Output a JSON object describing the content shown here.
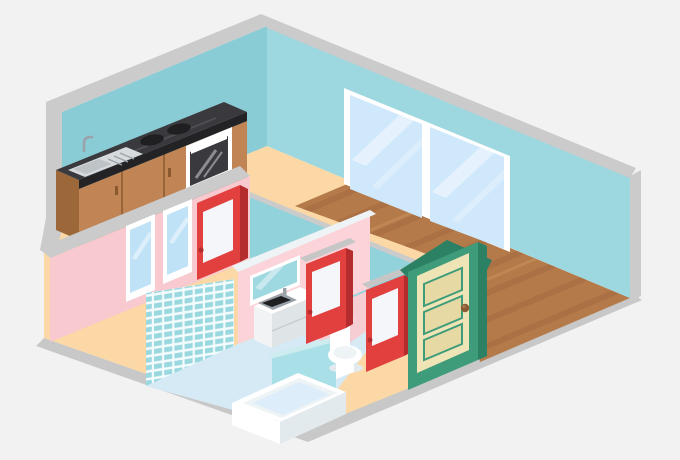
{
  "scene": {
    "type": "isometric-apartment-cutaway-illustration",
    "rooms": [
      {
        "name": "kitchen",
        "floor": "peach",
        "objects": [
          "kitchen-counter",
          "kitchen-sink",
          "stove-burners",
          "oven"
        ]
      },
      {
        "name": "living-room",
        "floor": "wood-planks",
        "objects": [
          "double-window",
          "entry-door"
        ]
      },
      {
        "name": "bedroom",
        "floor": "peach",
        "objects": [
          "bedroom-window-1",
          "bedroom-window-2",
          "bedroom-door"
        ]
      },
      {
        "name": "bathroom",
        "floor": "light-blue",
        "objects": [
          "tiled-wall",
          "bathtub",
          "vanity-sink",
          "mirror",
          "toilet",
          "half-wall",
          "bathroom-door",
          "wc-door"
        ]
      }
    ],
    "doors": {
      "red_interior_doors": 3,
      "green_entry_door": 1
    },
    "windows": {
      "large_double_window": 1,
      "bedroom_windows": 2
    }
  },
  "colors": {
    "bg": "#f2f2f2",
    "slab": "#c8c8c8",
    "cap": "#cbcbcb",
    "lintel": "#c6c6c6",
    "wallBlueLeft": "#8accd6",
    "wallBlueRight": "#9dd7df",
    "partitionTeal": "#92d2db",
    "floorPeach": "#fbd8a6",
    "wood": "#b47a49",
    "woodDark": "#a26940",
    "woodLight": "#c28b58",
    "pinkWall": "#f8c9cf",
    "pinkLight": "#fbd3d8",
    "bathFloor": "#d6eaf6",
    "bathPinkFloor": "#f5cdd3",
    "tileBg": "#f3fbfc",
    "tileTeal": "#9ad8e0",
    "halfWall": "#a9dfe6",
    "halfWallTop": "#cdecf0",
    "white": "#ffffff",
    "offWhite": "#eef3f6",
    "paleShadow": "#e2eaee",
    "glass": "#cfe8fb",
    "glassSmall": "#bfe2f7",
    "streak": "#ffffff",
    "mirror": "#9ed8e0",
    "red": "#e2403e",
    "redDark": "#b52c2e",
    "panelWhite": "#f4f6fa",
    "green": "#3f9c7b",
    "greenDark": "#2c8063",
    "cream": "#efe4b5",
    "creamDark": "#e7d9a4",
    "knob": "#8a5a33",
    "knobLight": "#a97a4a",
    "cabinet": "#c08455",
    "cabinetSide": "#9c6839",
    "cabinetDark": "#875831",
    "counter": "#3a3a3e",
    "counterEdge": "#232326",
    "counterStreak": "#57575d",
    "steel": "#d6dadd",
    "steelDark": "#9aa2a8",
    "black": "#1f1f22"
  }
}
